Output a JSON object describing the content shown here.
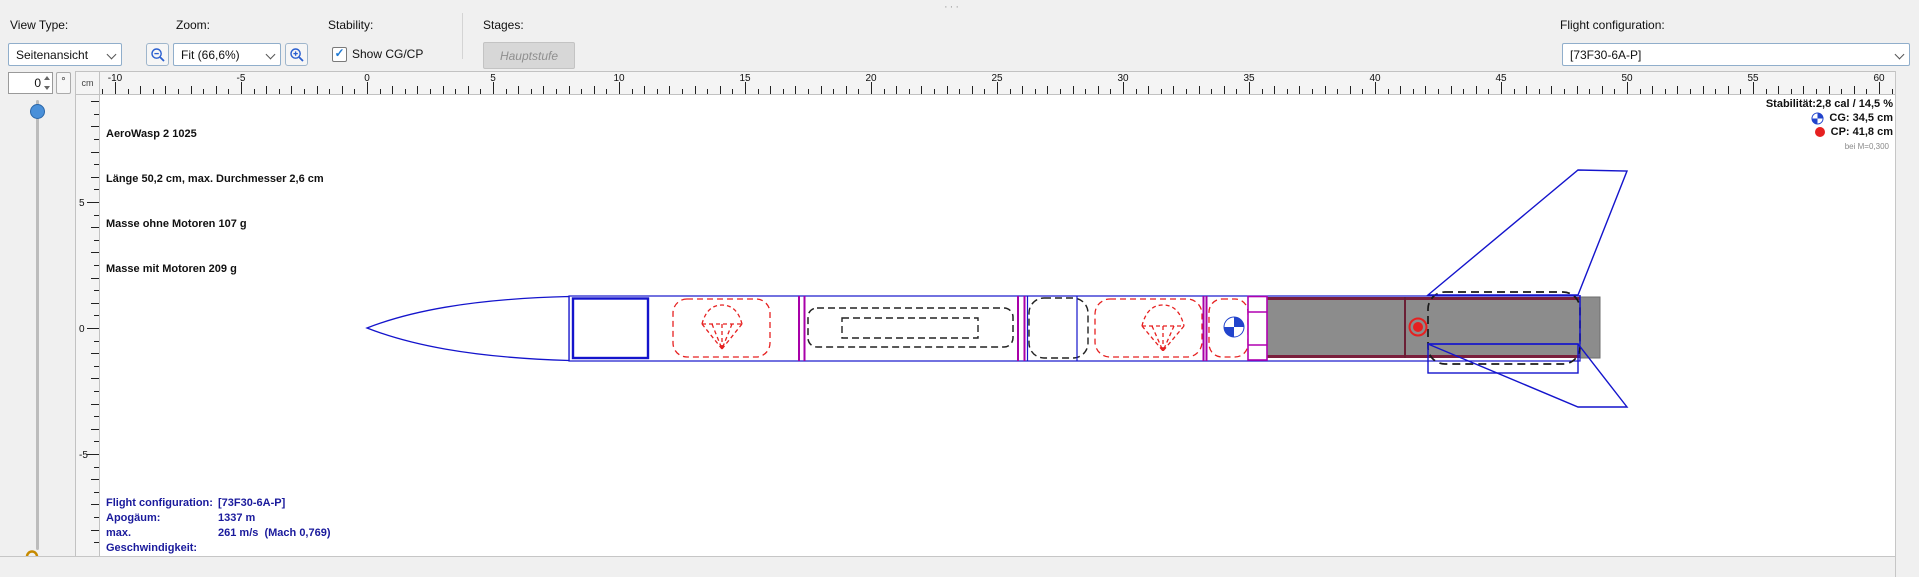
{
  "icons": {
    "splitter": "···"
  },
  "toolbar": {
    "view_type_label": "View Type:",
    "view_type_value": "Seitenansicht",
    "zoom_label": "Zoom:",
    "zoom_value": "Fit (66,6%)",
    "stability_label": "Stability:",
    "show_cgcp_label": "Show CG/CP",
    "stages_label": "Stages:",
    "stage_button_label": "Hauptstufe",
    "flight_config_label": "Flight configuration:",
    "flight_config_value": "[73F30-6A-P]"
  },
  "side_controls": {
    "rotation_value": "0",
    "rotation_unit": "°"
  },
  "rulers": {
    "unit": "cm",
    "h_labels": [
      "-10",
      "-5",
      "0",
      "5",
      "10",
      "15",
      "20",
      "25",
      "30",
      "35",
      "40",
      "45",
      "50",
      "55",
      "60"
    ],
    "v_labels": [
      "5",
      "0",
      "-5"
    ]
  },
  "rocket_info": {
    "name": "AeroWasp 2 1025",
    "dimensions": "Länge 50,2 cm, max. Durchmesser 2,6 cm",
    "mass_empty": "Masse ohne Motoren 107 g",
    "mass_loaded": "Masse mit Motoren 209 g"
  },
  "stability_info": {
    "stability": "Stabilität:2,8 cal / 14,5 %",
    "cg": "CG: 34,5 cm",
    "cp": "CP: 41,8 cm",
    "condition": "bei M=0,300"
  },
  "flight_info": {
    "rows": [
      {
        "label": "Flight configuration:",
        "value": "[73F30-6A-P]"
      },
      {
        "label": "Apogäum:",
        "value": "1337 m"
      },
      {
        "label": "max. Geschwindigkeit:",
        "value": "261 m/s  (Mach 0,769)"
      },
      {
        "label": "max. Beschleunigung:",
        "value": "253 m/s²"
      }
    ]
  }
}
